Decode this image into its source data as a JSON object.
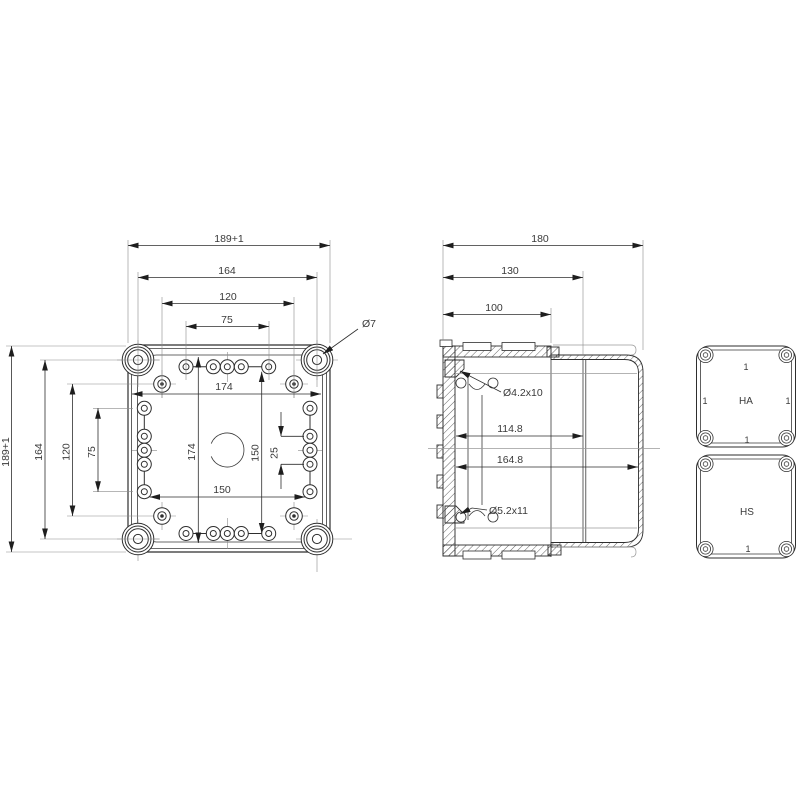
{
  "front": {
    "dim_outer": "189+1",
    "dim_screws": "164",
    "dim_bosses": "120",
    "dim_slots": "75",
    "dim_inner_w": "174",
    "dim_inner_h": "174",
    "dim_mount_h": "150",
    "dim_mount_w": "150",
    "dim_pitch": "25",
    "callout_hole": "Ø7"
  },
  "side": {
    "dim_depth": "180",
    "dim_lid": "130",
    "dim_base": "100",
    "dim_inner_base": "114.8",
    "dim_inner_total": "164.8",
    "callout_top": "Ø4.2x10",
    "callout_bottom": "Ø5.2x11"
  },
  "details": {
    "ha_label": "HA",
    "hs_label": "HS",
    "mark": "1"
  },
  "colors": {
    "line": "#2e2e2e",
    "thin_line": "#8a8a8a",
    "text": "#3a3a3a",
    "background": "#ffffff"
  }
}
